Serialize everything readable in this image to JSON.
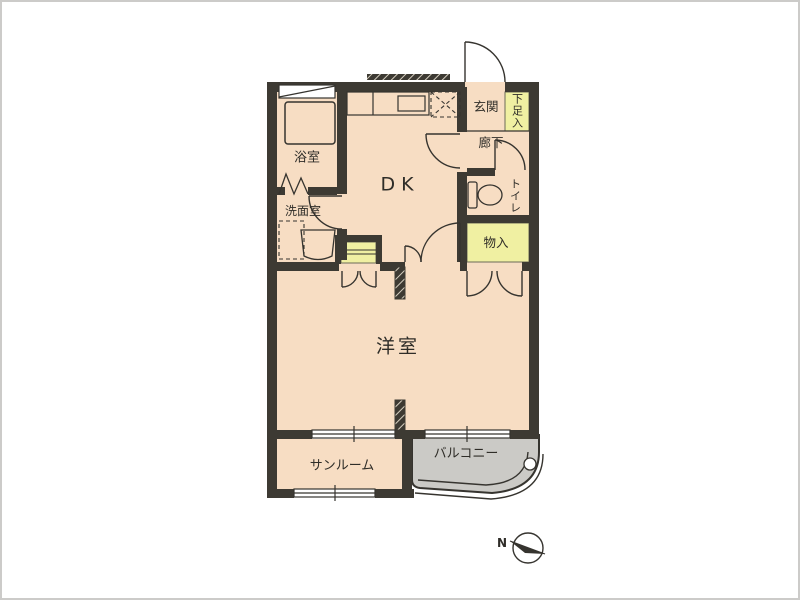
{
  "floorplan": {
    "labels": {
      "bathroom": "浴室",
      "washroom": "洗面室",
      "dining_kitchen": "DK",
      "entrance": "玄関",
      "shoe_cabinet": "下足入",
      "hallway": "廊下",
      "toilet": "トイレ",
      "storage": "物入",
      "western_room": "洋室",
      "sunroom": "サンルーム",
      "balcony": "バルコニー",
      "north": "N"
    },
    "colors": {
      "floor": "#f7ddc3",
      "storage_fill": "#f0f0a2",
      "balcony_fill": "#cbcac6",
      "wall": "#3d3a33",
      "line": "#36342f",
      "page_border": "#cccbc9"
    }
  }
}
